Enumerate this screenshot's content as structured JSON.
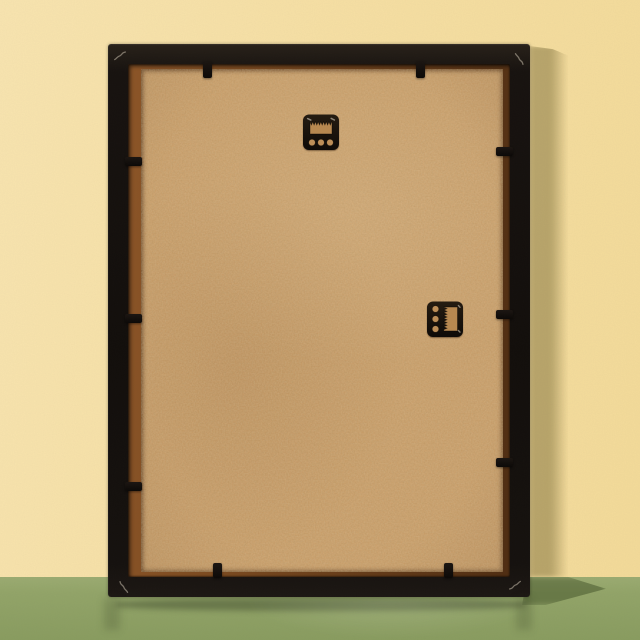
{
  "scene": {
    "objects": {
      "wall": "pale-yellow-wall",
      "floor": "sage-green-glossy-surface",
      "frame": "black-picture-frame-back",
      "backing_board": "tan-mdf-backing-board",
      "hanger_top": "black-sawtooth-hanger-portrait",
      "hanger_side": "black-sawtooth-hanger-landscape",
      "tabs": "black-retainer-tabs",
      "v_nails": "metal-v-nail-corner-marks"
    },
    "colors": {
      "wall": "#f7e0a4",
      "wall_light": "#f9e5b0",
      "wall_dark": "#f4db99",
      "wall_shadow": "rgba(96,84,34,0.40)",
      "floor": "#93a569",
      "floor_dark": "#8a9d60",
      "floor_shadow": "rgba(56,72,30,0.45)",
      "frame_black": "#17120f",
      "frame_black_light": "#282119",
      "lip_brown": "#7d4b20",
      "lip_brown_dark": "#4f2d12",
      "board": "#cb9c65",
      "board_dark": "#ae8150",
      "hardware_black": "#140e08",
      "metal_glint": "#a39a8b"
    },
    "frame": {
      "x": 108,
      "y": 44,
      "width": 422,
      "height": 553,
      "border": 20
    },
    "lip": {
      "left": 13,
      "top": 5,
      "right": 7,
      "bottom": 5
    },
    "floor_line_y": 577,
    "wall_shadow_band": {
      "x": 530,
      "y": 46,
      "width": 38,
      "height": 531
    },
    "floor_shadow_patch": {
      "x": 522,
      "y": 577,
      "width": 84,
      "height": 28
    },
    "frame_reflection": {
      "x": 116,
      "y": 598,
      "width": 410,
      "height": 13
    },
    "reflection_columns": [
      {
        "x": 104,
        "y": 598,
        "width": 16,
        "height": 32
      },
      {
        "x": 516,
        "y": 598,
        "width": 16,
        "height": 32
      }
    ],
    "floor_sheen": {
      "x": 240,
      "y": 600,
      "width": 300,
      "height": 40
    },
    "hangers": [
      {
        "id": "sawtooth-hanger-top",
        "x": 302,
        "y": 113,
        "width": 38,
        "height": 38
      },
      {
        "id": "sawtooth-hanger-side",
        "x": 426,
        "y": 300,
        "width": 38,
        "height": 38
      }
    ],
    "tabs": [
      {
        "side": "top",
        "pos": 207
      },
      {
        "side": "top",
        "pos": 420
      },
      {
        "side": "left",
        "pos": 161
      },
      {
        "side": "left",
        "pos": 318
      },
      {
        "side": "left",
        "pos": 486
      },
      {
        "side": "right",
        "pos": 151
      },
      {
        "side": "right",
        "pos": 314
      },
      {
        "side": "right",
        "pos": 462
      },
      {
        "side": "bottom",
        "pos": 217
      },
      {
        "side": "bottom",
        "pos": 448
      }
    ],
    "v_nails": [
      {
        "x": 113,
        "y": 49,
        "rot": 5
      },
      {
        "x": 512,
        "y": 52,
        "rot": 95
      },
      {
        "x": 117,
        "y": 580,
        "rot": -85
      },
      {
        "x": 508,
        "y": 578,
        "rot": 185
      }
    ]
  }
}
